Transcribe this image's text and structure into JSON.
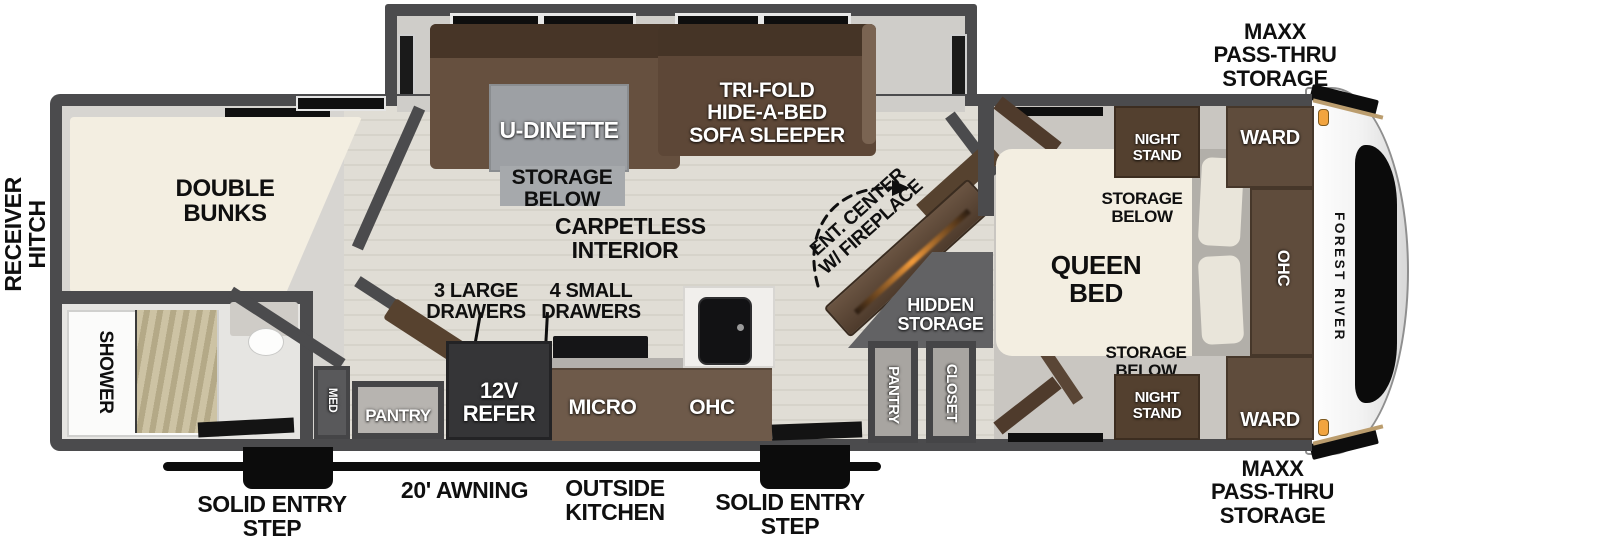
{
  "labels": {
    "receiver_hitch": {
      "line1": "RECEIVER",
      "line2": "HITCH"
    },
    "maxx_top": {
      "line1": "MAXX",
      "line2": "PASS-THRU",
      "line3": "STORAGE"
    },
    "maxx_bottom": {
      "line1": "MAXX",
      "line2": "PASS-THRU",
      "line3": "STORAGE"
    },
    "awning": "20' AWNING",
    "outside_kitchen": {
      "line1": "OUTSIDE",
      "line2": "KITCHEN"
    },
    "step_left": {
      "line1": "SOLID ENTRY",
      "line2": "STEP"
    },
    "step_right": {
      "line1": "SOLID ENTRY",
      "line2": "STEP"
    }
  },
  "rooms": {
    "double_bunks": {
      "line1": "DOUBLE",
      "line2": "BUNKS"
    },
    "shower": "SHOWER",
    "med": "MED",
    "pantry_bath": "PANTRY",
    "u_dinette": "U-DINETTE",
    "dinette_storage": {
      "line1": "STORAGE",
      "line2": "BELOW"
    },
    "sofa": {
      "line1": "TRI-FOLD",
      "line2": "HIDE-A-BED",
      "line3": "SOFA SLEEPER"
    },
    "carpetless": {
      "line1": "CARPETLESS",
      "line2": "INTERIOR"
    },
    "large_drawers": {
      "line1": "3 LARGE",
      "line2": "DRAWERS"
    },
    "small_drawers": {
      "line1": "4 SMALL",
      "line2": "DRAWERS"
    },
    "refer": {
      "line1": "12V",
      "line2": "REFER"
    },
    "micro": "MICRO",
    "ohc_kitchen": "OHC",
    "ent_center": {
      "line1": "ENT. CENTER",
      "line2": "W/ FIREPLACE"
    },
    "hidden_storage": {
      "line1": "HIDDEN",
      "line2": "STORAGE"
    },
    "pantry_main": "PANTRY",
    "closet": "CLOSET",
    "queen_bed": {
      "line1": "QUEEN",
      "line2": "BED"
    },
    "storage_below_top": {
      "line1": "STORAGE",
      "line2": "BELOW"
    },
    "storage_below_bottom": {
      "line1": "STORAGE",
      "line2": "BELOW"
    },
    "night_stand_top": {
      "line1": "NIGHT",
      "line2": "STAND"
    },
    "night_stand_bottom": {
      "line1": "NIGHT",
      "line2": "STAND"
    },
    "ward_top": "WARD",
    "ward_bottom": "WARD",
    "ohc_bedroom": "OHC"
  },
  "brand": {
    "name": "FOREST RIVER"
  },
  "colors": {
    "wall": "#4b4b4d",
    "accent_orange": "#f2a43f",
    "furniture_brown": "#5d4737",
    "bed_cream": "#f3eee1"
  }
}
